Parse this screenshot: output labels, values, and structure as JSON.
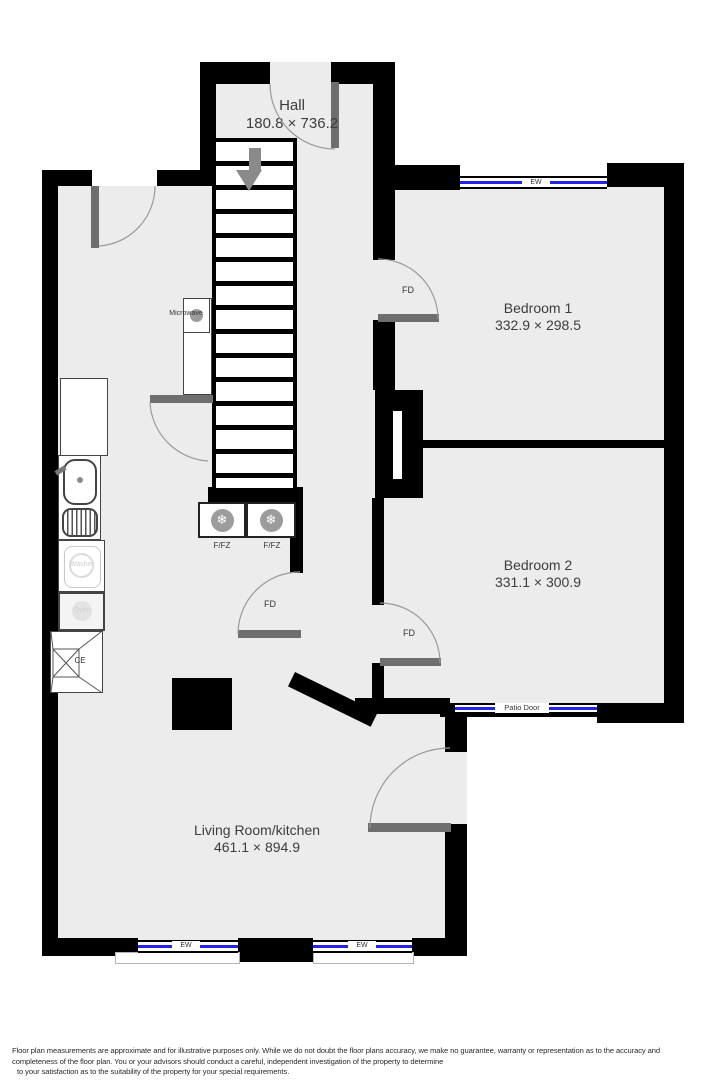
{
  "floorplan": {
    "rooms": {
      "hall": {
        "name": "Hall",
        "dimensions": "180.8 × 736.2"
      },
      "bedroom1": {
        "name": "Bedroom 1",
        "dimensions": "332.9 × 298.5"
      },
      "bedroom2": {
        "name": "Bedroom 2",
        "dimensions": "331.1 × 300.9"
      },
      "living": {
        "name": "Living Room/kitchen",
        "dimensions": "461.1 × 894.9"
      }
    },
    "labels": {
      "fire_door": "FD",
      "window": "EW",
      "patio_door": "Patio Door",
      "fridge_freezer": "F/FZ",
      "microwave": "Microwave",
      "washer": "Washer",
      "oven": "Oven",
      "cooker": "CE"
    },
    "icons": {
      "snowflake_glyph": "❄"
    },
    "colors": {
      "wall": "#000000",
      "floor": "#ececec",
      "window_line": "#2323e8",
      "door_leaf": "#6e6e6e",
      "arc": "#999999"
    }
  },
  "disclaimer": {
    "line1": "Floor plan measurements are approximate and for illustrative purposes only. While we do not doubt the floor plans accuracy, we make no guarantee, warranty or representation as to the accuracy and",
    "line2": "completeness of the floor plan. You or your advisors should conduct a careful, independent investigation of the property to determine",
    "line3": "to your satisfaction as to the suitability of the property for your special requirements."
  }
}
